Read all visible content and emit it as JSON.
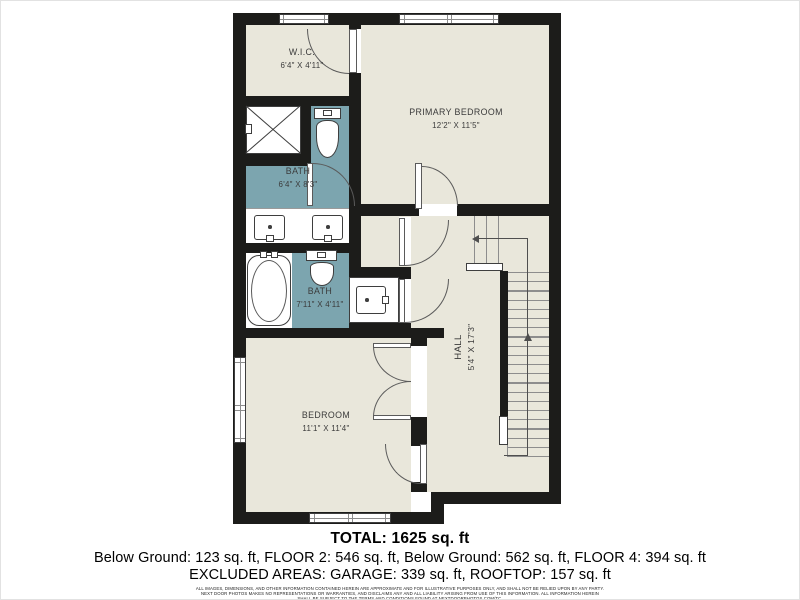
{
  "plan": {
    "rooms": [
      {
        "id": "wic",
        "name": "W.I.C.",
        "dims": "6'4\" X 4'11\""
      },
      {
        "id": "primary-bedroom",
        "name": "PRIMARY BEDROOM",
        "dims": "12'2\" X 11'5\""
      },
      {
        "id": "bath-upper",
        "name": "BATH",
        "dims": "6'4\" X 8'3\""
      },
      {
        "id": "bath-lower",
        "name": "BATH",
        "dims": "7'11\" X 4'11\""
      },
      {
        "id": "hall",
        "name": "HALL",
        "dims": "5'4\" X 17'3\""
      },
      {
        "id": "bedroom",
        "name": "BEDROOM",
        "dims": "11'1\" X 11'4\""
      }
    ],
    "colors": {
      "wall": "#1c1c1a",
      "floor": "#e9e7db",
      "bath_fill": "#7ca5af",
      "fixture_line": "#3e3e3e"
    }
  },
  "summary": {
    "total": "TOTAL: 1625 sq. ft",
    "floors": "Below Ground: 123 sq. ft, FLOOR 2: 546 sq. ft, Below Ground: 562 sq. ft, FLOOR 4: 394 sq. ft",
    "excluded": "EXCLUDED AREAS: GARAGE: 339 sq. ft, ROOFTOP: 157 sq. ft",
    "disclaimer_line1": "ALL IMAGES, DIMENSIONS, AND OTHER INFORMATION CONTAINED HEREIN ARE APPROXIMATE AND FOR ILLUSTRATIVE PURPOSES ONLY, AND SHALL NOT BE RELIED UPON BY ANY PARTY.",
    "disclaimer_line2": "NEXT DOOR PHOTOS MAKES NO REPRESENTATIONS OR WARRANTIES, AND DISCLAIMS ANY AND ALL LIABILITY ARISING FROM USE OF THIS INFORMATION. ALL INFORMATION HEREIN",
    "disclaimer_line3": "SHALL BE SUBJECT TO THE TERMS AND CONDITIONS FOUND AT NEXTDOORPHOTOS.COM/TC."
  }
}
